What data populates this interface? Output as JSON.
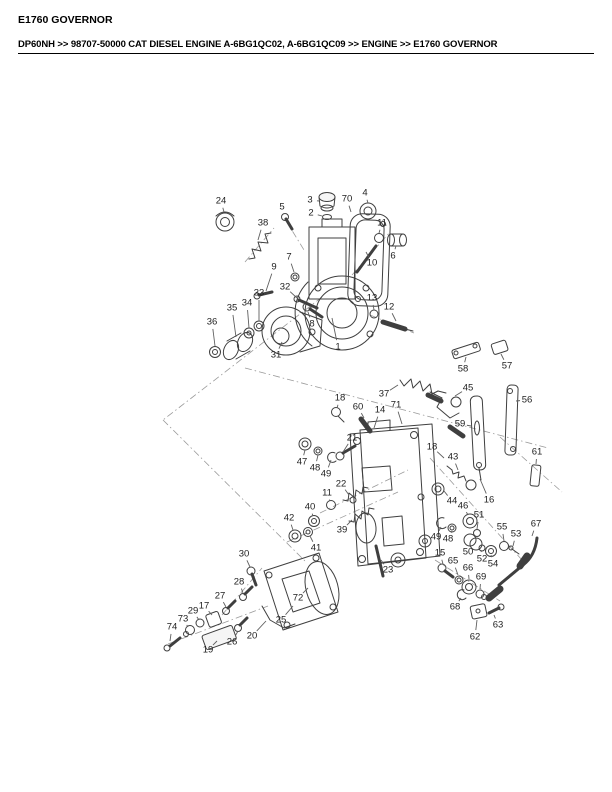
{
  "page": {
    "title": "E1760 GOVERNOR",
    "breadcrumb": "DP60NH >> 98707-50000 CAT DIESEL ENGINE A-6BG1QC02, A-6BG1QC09 >> ENGINE >> E1760 GOVERNOR"
  },
  "colors": {
    "text": "#000000",
    "line_art": "#3f3f3f",
    "leader": "#5f5f5f",
    "construction": "#9a9a9a"
  },
  "diagram": {
    "type": "exploded-parts-diagram",
    "subject": "Governor assembly exploded view with numbered part callouts",
    "callouts": [
      {
        "label": "1",
        "x": 338,
        "y": 347,
        "tx": 332,
        "ty": 318
      },
      {
        "label": "2",
        "x": 311,
        "y": 213,
        "tx": 322,
        "ty": 216
      },
      {
        "label": "3",
        "x": 310,
        "y": 200,
        "tx": 319,
        "ty": 201
      },
      {
        "label": "4",
        "x": 365,
        "y": 193,
        "tx": 368,
        "ty": 203
      },
      {
        "label": "5",
        "x": 282,
        "y": 207,
        "tx": 285,
        "ty": 214
      },
      {
        "label": "6",
        "x": 393,
        "y": 256,
        "tx": 396,
        "ty": 246
      },
      {
        "label": "7",
        "x": 289,
        "y": 257,
        "tx": 294,
        "ty": 272
      },
      {
        "label": "8",
        "x": 312,
        "y": 324,
        "tx": 308,
        "ty": 312
      },
      {
        "label": "9",
        "x": 274,
        "y": 267,
        "tx": 266,
        "ty": 291
      },
      {
        "label": "10",
        "x": 372,
        "y": 263,
        "tx": 366,
        "ty": 252
      },
      {
        "label": "11",
        "x": 382,
        "y": 223,
        "tx": 379,
        "ty": 233
      },
      {
        "label": "11",
        "x": 327,
        "y": 493,
        "tx": 330,
        "ty": 501
      },
      {
        "label": "12",
        "x": 389,
        "y": 307,
        "tx": 396,
        "ty": 321
      },
      {
        "label": "13",
        "x": 372,
        "y": 298,
        "tx": 374,
        "ty": 310
      },
      {
        "label": "14",
        "x": 380,
        "y": 410,
        "tx": 374,
        "ty": 428
      },
      {
        "label": "15",
        "x": 440,
        "y": 553,
        "tx": 443,
        "ty": 564
      },
      {
        "label": "16",
        "x": 489,
        "y": 500,
        "tx": 480,
        "ty": 479
      },
      {
        "label": "17",
        "x": 204,
        "y": 606,
        "tx": 212,
        "ty": 615
      },
      {
        "label": "18",
        "x": 340,
        "y": 398,
        "tx": 337,
        "ty": 408
      },
      {
        "label": "18",
        "x": 432,
        "y": 447,
        "tx": 444,
        "ty": 458
      },
      {
        "label": "19",
        "x": 208,
        "y": 650,
        "tx": 217,
        "ty": 641
      },
      {
        "label": "20",
        "x": 252,
        "y": 636,
        "tx": 266,
        "ty": 621
      },
      {
        "label": "21",
        "x": 352,
        "y": 438,
        "tx": 343,
        "ty": 452
      },
      {
        "label": "22",
        "x": 341,
        "y": 484,
        "tx": 349,
        "ty": 495
      },
      {
        "label": "23",
        "x": 388,
        "y": 570,
        "tx": 381,
        "ty": 560
      },
      {
        "label": "24",
        "x": 221,
        "y": 201,
        "tx": 224,
        "ty": 212
      },
      {
        "label": "25",
        "x": 281,
        "y": 620,
        "tx": 293,
        "ty": 606
      },
      {
        "label": "26",
        "x": 232,
        "y": 642,
        "tx": 238,
        "ty": 631
      },
      {
        "label": "27",
        "x": 220,
        "y": 596,
        "tx": 226,
        "ty": 607
      },
      {
        "label": "28",
        "x": 239,
        "y": 582,
        "tx": 243,
        "ty": 593
      },
      {
        "label": "29",
        "x": 193,
        "y": 611,
        "tx": 199,
        "ty": 620
      },
      {
        "label": "30",
        "x": 244,
        "y": 554,
        "tx": 250,
        "ty": 567
      },
      {
        "label": "31",
        "x": 276,
        "y": 355,
        "tx": 282,
        "ty": 342
      },
      {
        "label": "32",
        "x": 285,
        "y": 287,
        "tx": 297,
        "ty": 298
      },
      {
        "label": "33",
        "x": 259,
        "y": 293,
        "tx": 259,
        "ty": 321
      },
      {
        "label": "34",
        "x": 247,
        "y": 303,
        "tx": 249,
        "ty": 328
      },
      {
        "label": "35",
        "x": 232,
        "y": 308,
        "tx": 236,
        "ty": 337
      },
      {
        "label": "36",
        "x": 212,
        "y": 322,
        "tx": 215,
        "ty": 346
      },
      {
        "label": "37",
        "x": 384,
        "y": 394,
        "tx": 398,
        "ty": 385
      },
      {
        "label": "38",
        "x": 263,
        "y": 223,
        "tx": 258,
        "ty": 240
      },
      {
        "label": "39",
        "x": 342,
        "y": 530,
        "tx": 352,
        "ty": 520
      },
      {
        "label": "40",
        "x": 310,
        "y": 507,
        "tx": 313,
        "ty": 516
      },
      {
        "label": "41",
        "x": 316,
        "y": 548,
        "tx": 310,
        "ty": 536
      },
      {
        "label": "42",
        "x": 289,
        "y": 518,
        "tx": 293,
        "ty": 530
      },
      {
        "label": "43",
        "x": 453,
        "y": 457,
        "tx": 458,
        "ty": 470
      },
      {
        "label": "44",
        "x": 452,
        "y": 501,
        "tx": 444,
        "ty": 491
      },
      {
        "label": "45",
        "x": 468,
        "y": 388,
        "tx": 455,
        "ty": 396
      },
      {
        "label": "46",
        "x": 463,
        "y": 506,
        "tx": 468,
        "ty": 515
      },
      {
        "label": "47",
        "x": 302,
        "y": 462,
        "tx": 305,
        "ty": 450
      },
      {
        "label": "48",
        "x": 315,
        "y": 468,
        "tx": 318,
        "ty": 455
      },
      {
        "label": "48",
        "x": 448,
        "y": 539,
        "tx": 452,
        "ty": 531
      },
      {
        "label": "49",
        "x": 326,
        "y": 474,
        "tx": 331,
        "ty": 460
      },
      {
        "label": "49",
        "x": 436,
        "y": 537,
        "tx": 441,
        "ty": 527
      },
      {
        "label": "50",
        "x": 468,
        "y": 552,
        "tx": 470,
        "ty": 545
      },
      {
        "label": "51",
        "x": 479,
        "y": 515,
        "tx": 477,
        "ty": 529
      },
      {
        "label": "52",
        "x": 482,
        "y": 559,
        "tx": 481,
        "ty": 550
      },
      {
        "label": "53",
        "x": 516,
        "y": 534,
        "tx": 513,
        "ty": 546
      },
      {
        "label": "54",
        "x": 493,
        "y": 564,
        "tx": 491,
        "ty": 555
      },
      {
        "label": "55",
        "x": 502,
        "y": 527,
        "tx": 504,
        "ty": 541
      },
      {
        "label": "56",
        "x": 527,
        "y": 400,
        "tx": 516,
        "ty": 401
      },
      {
        "label": "57",
        "x": 507,
        "y": 366,
        "tx": 501,
        "ty": 354
      },
      {
        "label": "58",
        "x": 463,
        "y": 369,
        "tx": 466,
        "ty": 357
      },
      {
        "label": "59",
        "x": 460,
        "y": 424,
        "tx": 471,
        "ty": 426
      },
      {
        "label": "60",
        "x": 358,
        "y": 407,
        "tx": 364,
        "ty": 418
      },
      {
        "label": "61",
        "x": 537,
        "y": 452,
        "tx": 536,
        "ty": 464
      },
      {
        "label": "62",
        "x": 475,
        "y": 637,
        "tx": 477,
        "ty": 620
      },
      {
        "label": "63",
        "x": 498,
        "y": 625,
        "tx": 494,
        "ty": 615
      },
      {
        "label": "65",
        "x": 453,
        "y": 561,
        "tx": 458,
        "ty": 575
      },
      {
        "label": "66",
        "x": 468,
        "y": 568,
        "tx": 469,
        "ty": 579
      },
      {
        "label": "67",
        "x": 536,
        "y": 524,
        "tx": 532,
        "ty": 536
      },
      {
        "label": "68",
        "x": 455,
        "y": 607,
        "tx": 461,
        "ty": 598
      },
      {
        "label": "69",
        "x": 481,
        "y": 577,
        "tx": 480,
        "ty": 589
      },
      {
        "label": "70",
        "x": 347,
        "y": 199,
        "tx": 351,
        "ty": 212
      },
      {
        "label": "71",
        "x": 396,
        "y": 405,
        "tx": 402,
        "ty": 424
      },
      {
        "label": "72",
        "x": 298,
        "y": 598,
        "tx": 308,
        "ty": 588
      },
      {
        "label": "73",
        "x": 183,
        "y": 619,
        "tx": 188,
        "ty": 627
      },
      {
        "label": "74",
        "x": 172,
        "y": 627,
        "tx": 170,
        "ty": 641
      }
    ]
  }
}
